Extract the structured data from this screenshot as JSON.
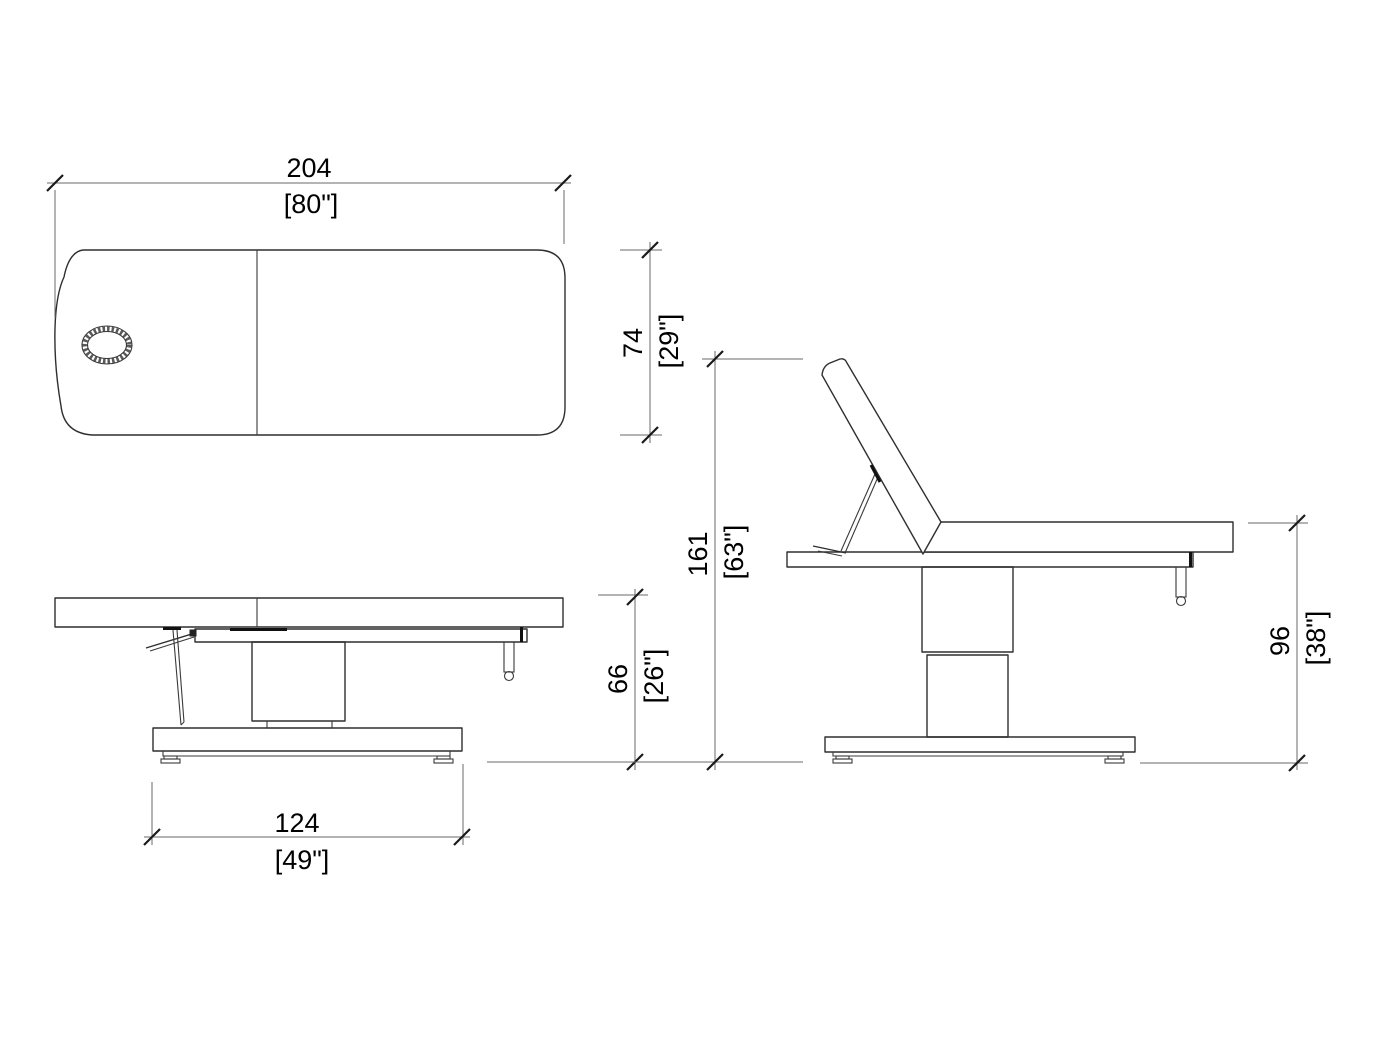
{
  "drawing": {
    "type": "technical-dimension-drawing",
    "subject": "treatment-table-three-views",
    "units": {
      "primary": "cm",
      "secondary": "inches"
    },
    "colors": {
      "background": "#ffffff",
      "object_line": "#2f2f2f",
      "dimension_line": "#6a6a6a",
      "text": "#000000"
    },
    "dimensions": {
      "overall_length": {
        "cm": "204",
        "in": "[80\"]"
      },
      "overall_width": {
        "cm": "74",
        "in": "[29\"]"
      },
      "base_length": {
        "cm": "124",
        "in": "[49\"]"
      },
      "min_height": {
        "cm": "66",
        "in": "[26\"]"
      },
      "backrest_raised_height": {
        "cm": "161",
        "in": "[63\"]"
      },
      "max_height": {
        "cm": "96",
        "in": "[38\"]"
      }
    }
  }
}
